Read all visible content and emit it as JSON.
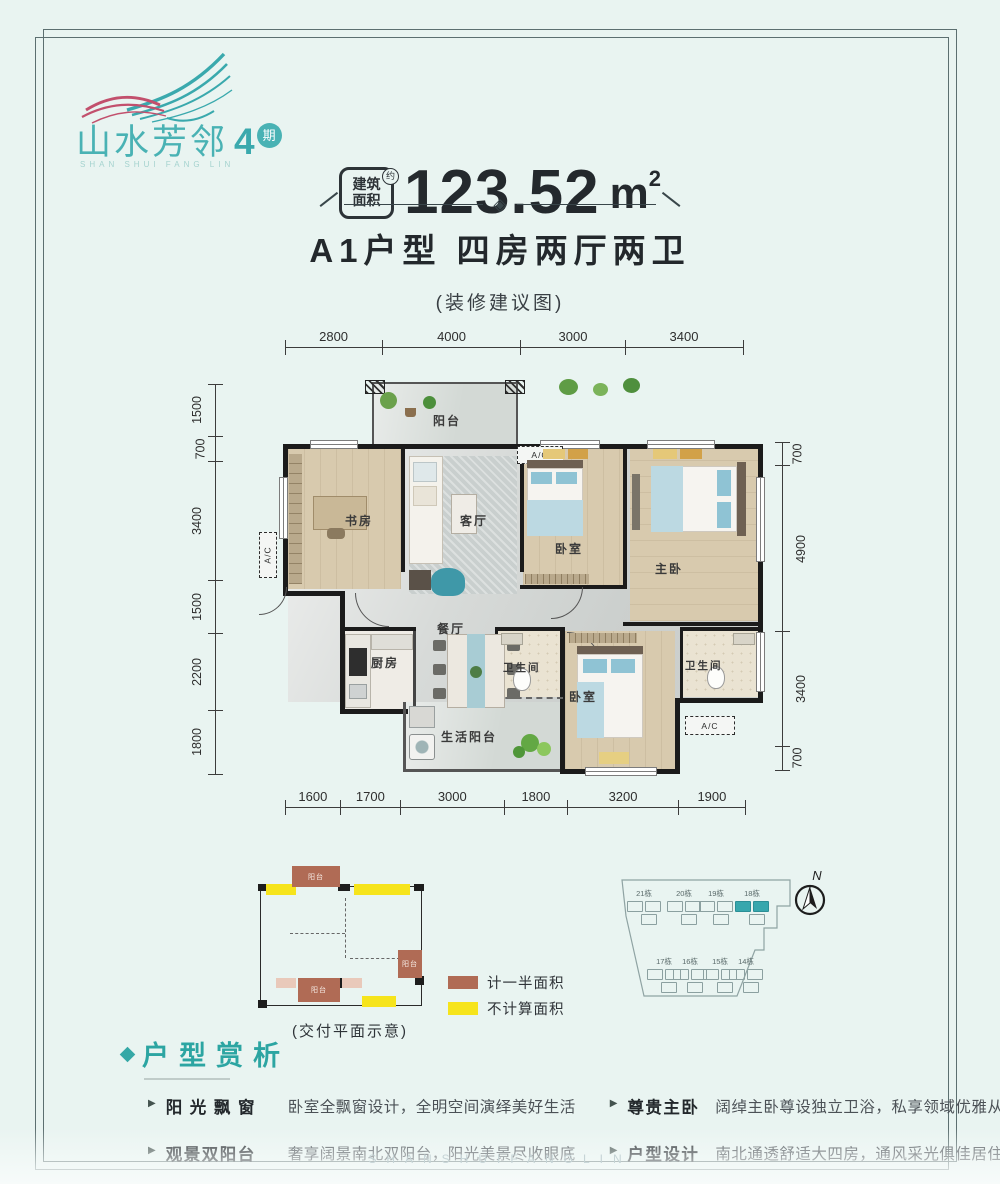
{
  "logo": {
    "name": "山水芳邻",
    "phase": "4",
    "phase_badge": "期",
    "subtitle": "SHAN SHUI FANG LIN"
  },
  "header": {
    "badge": {
      "line1": "建筑",
      "line2": "面积",
      "approx": "约"
    },
    "area_value": "123.52",
    "area_unit_base": "m",
    "area_unit_sup": "2",
    "title": "A1户型  四房两厅两卫",
    "subtitle": "(装修建议图)"
  },
  "floor_plan": {
    "dims_top": [
      "2800",
      "4000",
      "3000",
      "3400"
    ],
    "dims_bottom": [
      "1600",
      "1700",
      "3000",
      "1800",
      "3200",
      "1900"
    ],
    "dims_left": [
      "1500",
      "700",
      "3400",
      "1500",
      "2200",
      "1800"
    ],
    "dims_right": [
      "700",
      "4900",
      "3400",
      "700"
    ],
    "rooms": {
      "balcony": "阳台",
      "study": "书房",
      "living": "客厅",
      "bedroom2": "卧室",
      "master": "主卧",
      "dining": "餐厅",
      "kitchen": "厨房",
      "bath1": "卫生间",
      "bedroom3": "卧室",
      "bath2": "卫生间",
      "utility": "生活阳台"
    },
    "ac_label": "A/C"
  },
  "delivery_plan": {
    "caption": "(交付平面示意)",
    "balcony_label": "阳台",
    "legend": [
      {
        "label": "计一半面积",
        "color": "#b06b55"
      },
      {
        "label": "不计算面积",
        "color": "#f6e41c"
      }
    ]
  },
  "site_map": {
    "buildings": [
      "21栋",
      "20栋",
      "19栋",
      "18栋",
      "17栋",
      "16栋",
      "15栋",
      "14栋"
    ],
    "highlighted": "18栋",
    "compass": "N"
  },
  "analysis": {
    "title": "户型赏析",
    "features": [
      {
        "label": "阳 光 飘 窗",
        "desc": "卧室全飘窗设计，全明空间演绎美好生活"
      },
      {
        "label": "观景双阳台",
        "desc": "奢享阔景南北双阳台，阳光美景尽收眼底"
      },
      {
        "label": "尊贵主卧",
        "desc": "阔绰主卧尊设独立卫浴，私享领域优雅从容"
      },
      {
        "label": "户型设计",
        "desc": "南北通透舒适大四房，通风采光俱佳居住舒适"
      }
    ]
  },
  "watermark": "SHANSHUIFANGLIN",
  "colors": {
    "brand_teal": "#3aa9ad",
    "accent_pink": "#c2506d",
    "wall_black": "#1b1b1b"
  }
}
